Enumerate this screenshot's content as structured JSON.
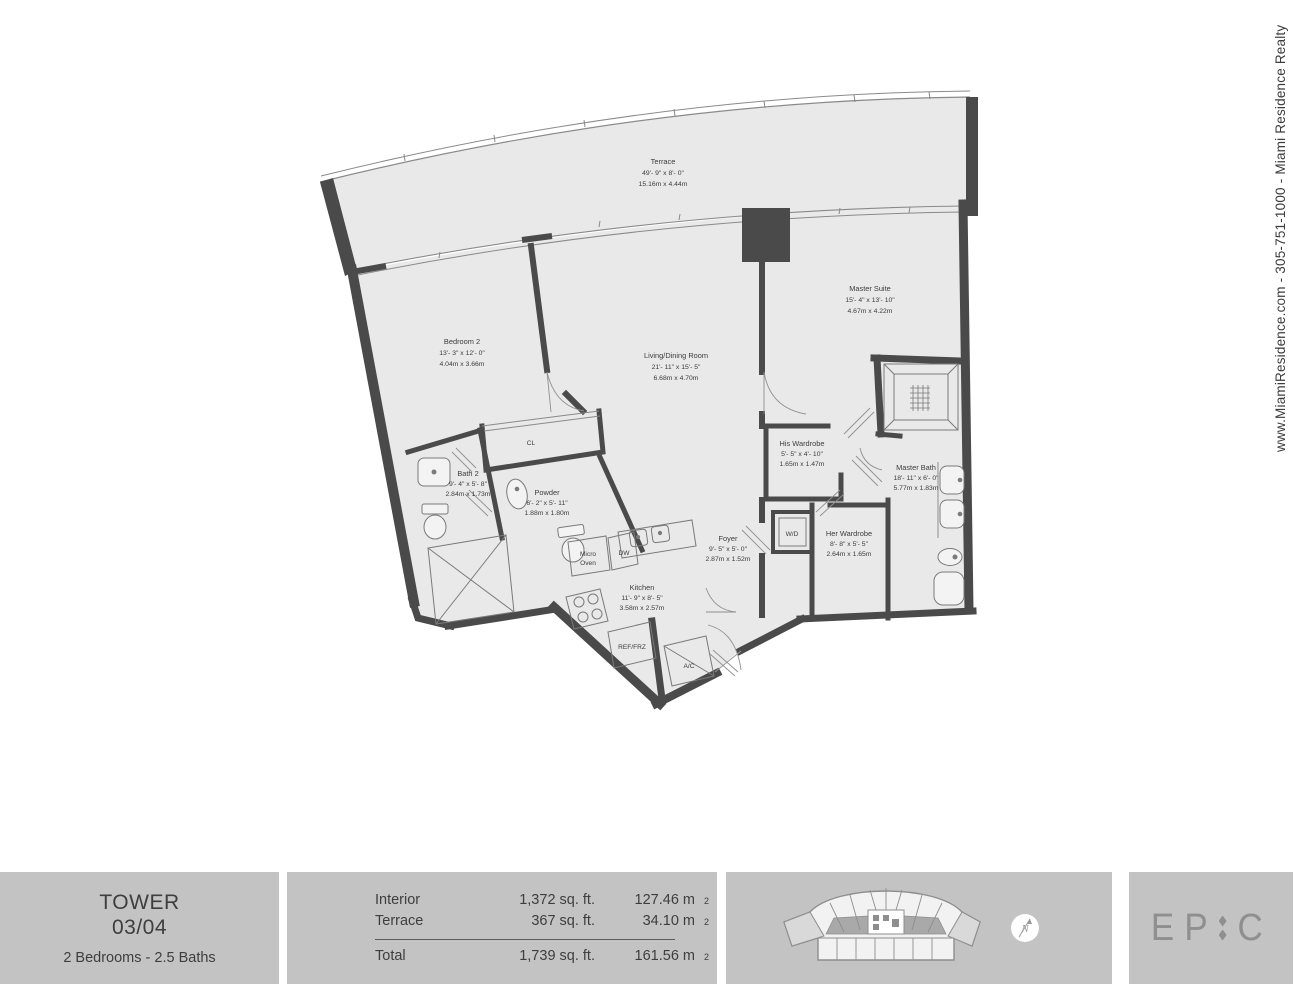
{
  "meta": {
    "title": "EPIC Tower 03/04 floor plan",
    "canvas_width": 1295,
    "canvas_height": 986
  },
  "colors": {
    "wall": "#4a4a4a",
    "floor": "#e9e9e9",
    "line": "#8a8a8a",
    "panel": "#c3c3c3",
    "text": "#3c3c3c",
    "brand": "#8f8f8f",
    "keyplan_highlight": "#dadada"
  },
  "sidebar": {
    "contact_text": "www.MiamiResidence.com  -  305-751-1000  -  Miami Residence Realty"
  },
  "plan": {
    "rooms": [
      {
        "name": "Terrace",
        "dim_ft": "49'- 9\" x 8'- 0\"",
        "dim_m": "15.16m x 4.44m"
      },
      {
        "name": "Bedroom 2",
        "dim_ft": "13'- 3\" x 12'- 0\"",
        "dim_m": "4.04m x 3.66m"
      },
      {
        "name": "Living/Dining Room",
        "dim_ft": "21'- 11\" x 15'- 5\"",
        "dim_m": "6.68m x 4.70m"
      },
      {
        "name": "Master Suite",
        "dim_ft": "15'- 4\" x 13'- 10\"",
        "dim_m": "4.67m x 4.22m"
      },
      {
        "name": "Bath 2",
        "dim_ft": "9'- 4\" x 5'- 8\"",
        "dim_m": "2.84m x 1.73m"
      },
      {
        "name": "Powder",
        "dim_ft": "6'- 2\" x 5'- 11\"",
        "dim_m": "1.88m x 1.80m"
      },
      {
        "name": "His Wardrobe",
        "dim_ft": "5'- 5\" x 4'- 10\"",
        "dim_m": "1.65m x 1.47m"
      },
      {
        "name": "Master Bath",
        "dim_ft": "18'- 11\" x 6'- 0\"",
        "dim_m": "5.77m x 1.83m"
      },
      {
        "name": "Her Wardrobe",
        "dim_ft": "8'- 8\" x 5'- 5\"",
        "dim_m": "2.64m x 1.65m"
      },
      {
        "name": "Foyer",
        "dim_ft": "9'- 5\" x 5'- 0\"",
        "dim_m": "2.87m x 1.52m"
      },
      {
        "name": "Kitchen",
        "dim_ft": "11'- 9\" x 8'- 5\"",
        "dim_m": "3.58m x 2.57m"
      }
    ],
    "fixtures": {
      "closet": "CL",
      "washer_dryer": "W/D",
      "micro_line1": "Micro",
      "micro_line2": "Oven",
      "dishwasher": "DW",
      "refrigerator": "REF/FRZ",
      "air_conditioner": "A/C"
    }
  },
  "footer": {
    "unit": {
      "building": "TOWER",
      "number": "03/04",
      "config": "2 Bedrooms - 2.5 Baths"
    },
    "areas": {
      "rows": [
        {
          "label": "Interior",
          "imperial": "1,372 sq. ft.",
          "metric": "127.46 m",
          "metric_sup": "2"
        },
        {
          "label": "Terrace",
          "imperial": "367 sq. ft.",
          "metric": "34.10 m",
          "metric_sup": "2"
        },
        {
          "label": "Total",
          "imperial": "1,739 sq. ft.",
          "metric": "161.56 m",
          "metric_sup": "2"
        }
      ]
    },
    "compass": {
      "letter": "N"
    },
    "brand": {
      "left": "EP",
      "right": "C"
    }
  }
}
